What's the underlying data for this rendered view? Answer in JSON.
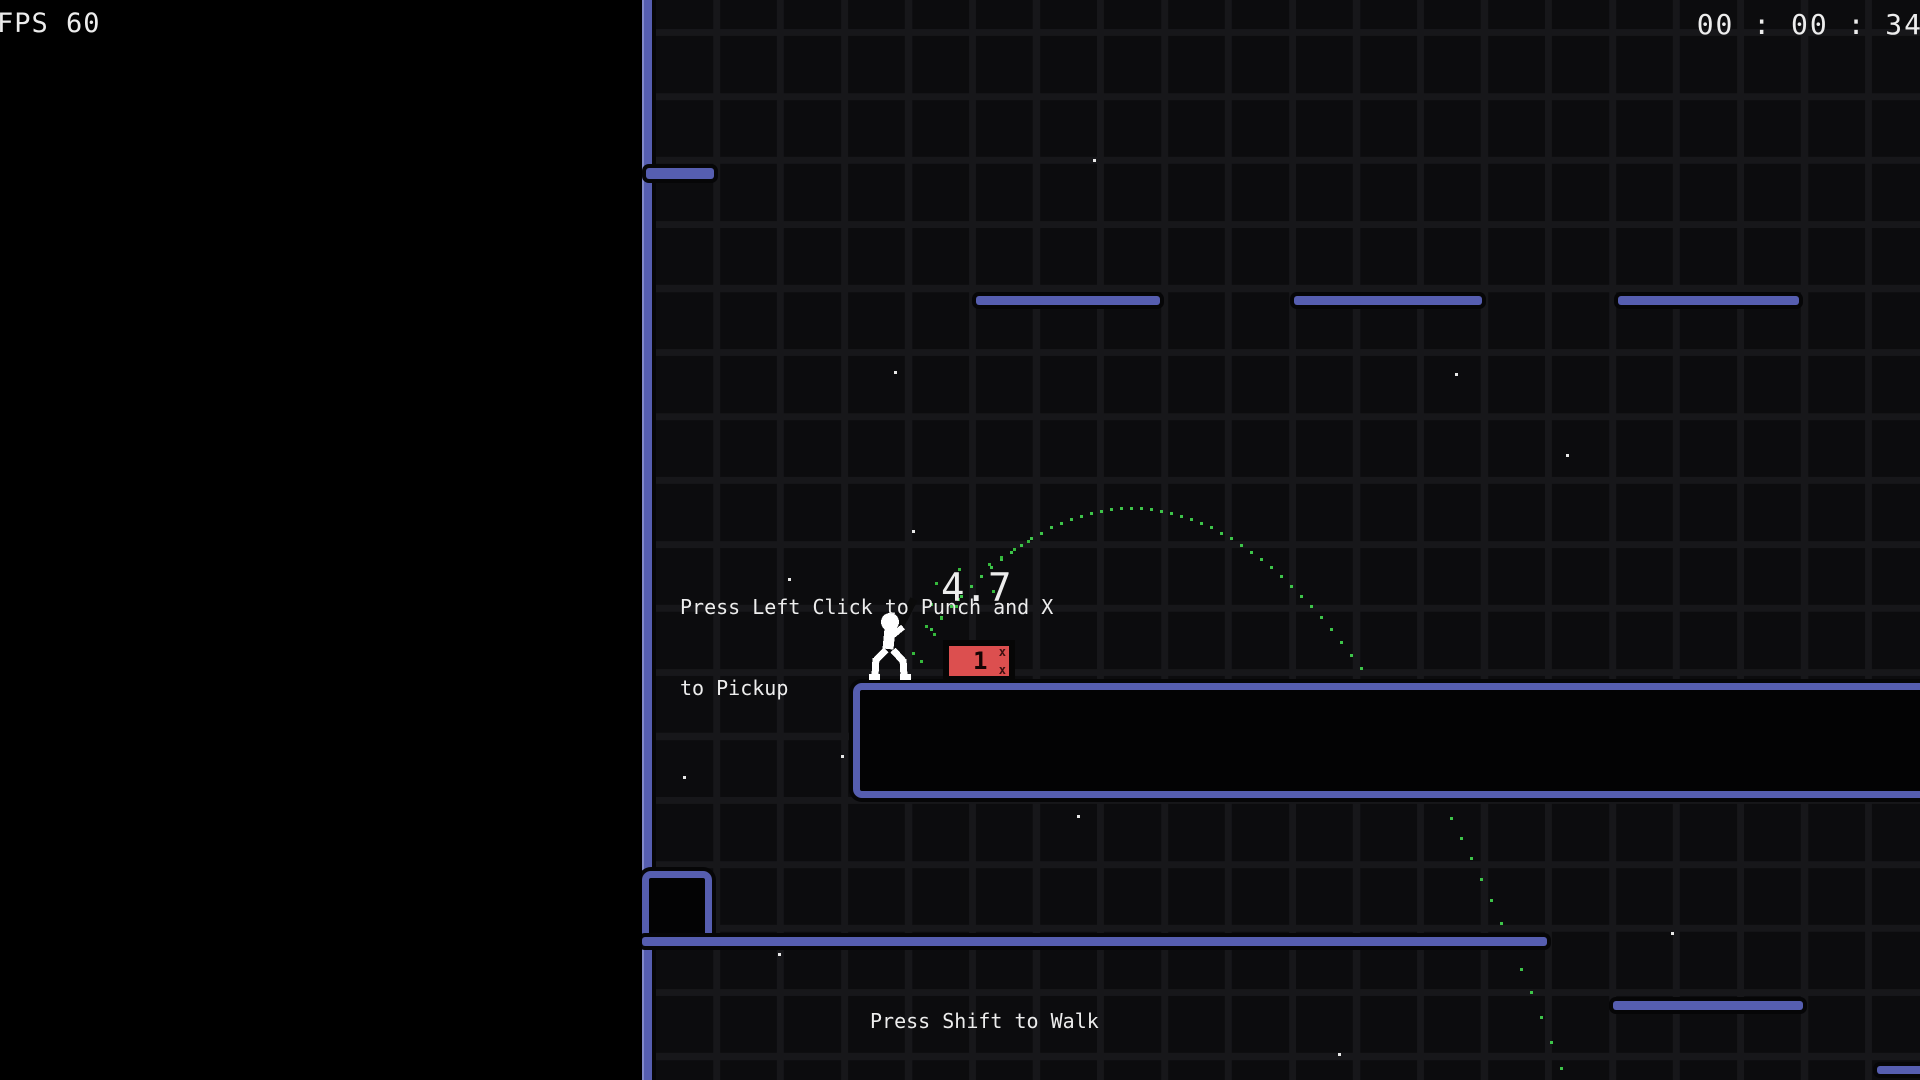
{
  "hud": {
    "fps": "FPS 60",
    "timer": "00 : 00 : 34"
  },
  "messages": {
    "punch_hint_line1": "Press Left Click to Punch and X",
    "punch_hint_line2": "to Pickup",
    "throw_power": "4.7",
    "walk_hint": "Press Shift to Walk"
  },
  "crate": {
    "count": "1",
    "mark_top": "x",
    "mark_bottom": "x"
  },
  "icons": {
    "player": "stick-figure-with-bat",
    "trajectory": "dotted-arc"
  },
  "colors": {
    "platform_blue": "#565eb0",
    "platform_highlight": "#8289ca",
    "crate_red": "#dc4f4f",
    "trajectory_green": "#3ec44a",
    "hud_text": "#ededed",
    "background": "#0c0c0e",
    "grid_line": "#17171a",
    "void": "#000000"
  },
  "world": {
    "platforms": [
      {
        "name": "left-wall",
        "style": "solid",
        "x": 642,
        "y": 0,
        "w": 8,
        "h": 1080
      },
      {
        "name": "upper-ledge",
        "style": "solid",
        "x": 646,
        "y": 168,
        "w": 68,
        "h": 11
      },
      {
        "name": "float-platform-1",
        "style": "solid",
        "x": 976,
        "y": 296,
        "w": 184,
        "h": 9
      },
      {
        "name": "float-platform-2",
        "style": "solid",
        "x": 1294,
        "y": 296,
        "w": 188,
        "h": 9
      },
      {
        "name": "float-platform-3",
        "style": "solid",
        "x": 1618,
        "y": 296,
        "w": 181,
        "h": 9
      },
      {
        "name": "main-platform",
        "style": "outlined",
        "x": 853,
        "y": 683,
        "w": 1090,
        "h": 101
      },
      {
        "name": "small-box",
        "style": "outlined",
        "x": 642,
        "y": 871,
        "w": 56,
        "h": 58
      },
      {
        "name": "lower-long-platform",
        "style": "solid",
        "x": 642,
        "y": 937,
        "w": 905,
        "h": 9
      },
      {
        "name": "lower-right-platform",
        "style": "solid",
        "x": 1613,
        "y": 1001,
        "w": 190,
        "h": 9
      },
      {
        "name": "corner-platform",
        "style": "solid",
        "x": 1877,
        "y": 1066,
        "w": 50,
        "h": 8
      }
    ],
    "trajectory": {
      "vertex_x": 1130,
      "vertex_y": 507,
      "k": 0.003028,
      "x_start": 930,
      "x_end": 1564,
      "step": 10
    },
    "stars": [
      [
        1093,
        159
      ],
      [
        894,
        371
      ],
      [
        1455,
        373
      ],
      [
        1566,
        454
      ],
      [
        912,
        530
      ],
      [
        788,
        578
      ],
      [
        683,
        776
      ],
      [
        841,
        755
      ],
      [
        1077,
        815
      ],
      [
        778,
        953
      ],
      [
        1671,
        932
      ],
      [
        1338,
        1053
      ]
    ],
    "particles": [
      [
        955,
        605
      ],
      [
        940,
        617
      ],
      [
        925,
        625
      ],
      [
        933,
        633
      ],
      [
        912,
        652
      ],
      [
        957,
        598
      ],
      [
        958,
        568
      ],
      [
        988,
        563
      ],
      [
        935,
        582
      ],
      [
        992,
        590
      ],
      [
        930,
        603
      ],
      [
        947,
        640
      ],
      [
        1000,
        556
      ],
      [
        1013,
        548
      ],
      [
        1027,
        540
      ],
      [
        920,
        660
      ]
    ]
  }
}
